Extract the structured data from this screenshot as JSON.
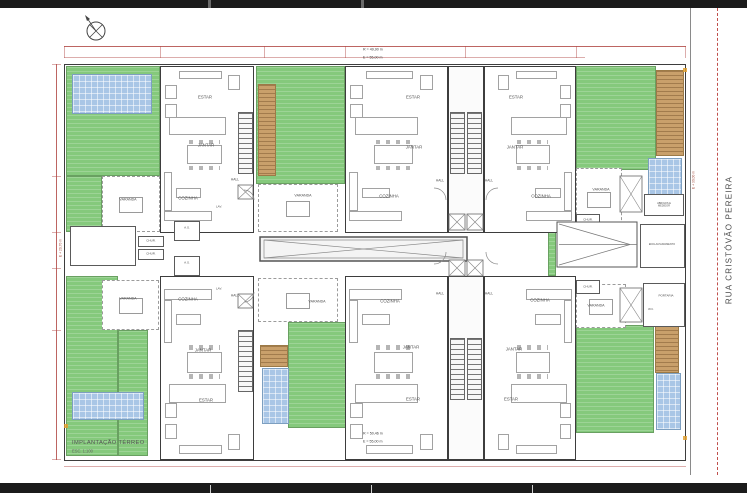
{
  "title_block": {
    "title": "IMPLANTAÇÃO TÉRREO",
    "scale": "ESC. 1:100"
  },
  "annotations": {
    "street": "RUA CRISTÓVÃO PEREIRA",
    "top_levels": [
      "R = 49,90 m",
      "E = 55,00 m"
    ],
    "bottom_levels": [
      "R = 50,46 m",
      "E = 55,00 m"
    ],
    "left_level": "E + 29,70 m",
    "right_level": "E + 30,00 m"
  },
  "colors": {
    "grass": "#85c97c",
    "pool": "#a9c6e6",
    "deck": "#c9a06b",
    "wall": "#3d3d3d",
    "dimension": "#b14a47",
    "furniture": "#a2a2a2"
  },
  "plan": {
    "zones": [
      {
        "kind": "grass",
        "x": 66,
        "y": 66,
        "w": 94,
        "h": 110
      },
      {
        "kind": "grass",
        "x": 66,
        "y": 176,
        "w": 36,
        "h": 56
      },
      {
        "kind": "grass",
        "x": 256,
        "y": 66,
        "w": 89,
        "h": 118
      },
      {
        "kind": "grass",
        "x": 576,
        "y": 66,
        "w": 80,
        "h": 104
      },
      {
        "kind": "grass",
        "x": 66,
        "y": 276,
        "w": 52,
        "h": 180
      },
      {
        "kind": "grass",
        "x": 118,
        "y": 330,
        "w": 30,
        "h": 126
      },
      {
        "kind": "grass",
        "x": 288,
        "y": 322,
        "w": 92,
        "h": 106
      },
      {
        "kind": "grass",
        "x": 576,
        "y": 325,
        "w": 78,
        "h": 108
      },
      {
        "kind": "grass",
        "x": 548,
        "y": 220,
        "w": 8,
        "h": 56
      },
      {
        "kind": "deck",
        "x": 258,
        "y": 84,
        "w": 18,
        "h": 92
      },
      {
        "kind": "deck",
        "x": 656,
        "y": 70,
        "w": 28,
        "h": 86
      },
      {
        "kind": "deck",
        "x": 260,
        "y": 345,
        "w": 28,
        "h": 22
      },
      {
        "kind": "deck",
        "x": 655,
        "y": 325,
        "w": 24,
        "h": 48
      },
      {
        "kind": "pool",
        "x": 72,
        "y": 74,
        "w": 80,
        "h": 40
      },
      {
        "kind": "pool",
        "x": 648,
        "y": 158,
        "w": 34,
        "h": 44
      },
      {
        "kind": "pool",
        "x": 72,
        "y": 392,
        "w": 72,
        "h": 28
      },
      {
        "kind": "pool",
        "x": 262,
        "y": 368,
        "w": 27,
        "h": 56
      },
      {
        "kind": "pool",
        "x": 656,
        "y": 373,
        "w": 25,
        "h": 57
      }
    ],
    "varandas": [
      {
        "x": 102,
        "y": 176,
        "w": 58,
        "h": 56
      },
      {
        "x": 258,
        "y": 184,
        "w": 80,
        "h": 48
      },
      {
        "x": 576,
        "y": 168,
        "w": 46,
        "h": 62
      },
      {
        "x": 102,
        "y": 280,
        "w": 57,
        "h": 50
      },
      {
        "x": 258,
        "y": 278,
        "w": 80,
        "h": 44
      },
      {
        "x": 576,
        "y": 284,
        "w": 50,
        "h": 44
      }
    ],
    "units": [
      {
        "x": 160,
        "y": 66,
        "w": 94,
        "h": 167,
        "flip": false,
        "row": "top"
      },
      {
        "x": 345,
        "y": 66,
        "w": 103,
        "h": 167,
        "flip": false,
        "row": "top"
      },
      {
        "x": 484,
        "y": 66,
        "w": 92,
        "h": 167,
        "flip": true,
        "row": "top"
      },
      {
        "x": 160,
        "y": 276,
        "w": 94,
        "h": 184,
        "flip": false,
        "row": "bottom"
      },
      {
        "x": 345,
        "y": 276,
        "w": 103,
        "h": 184,
        "flip": false,
        "row": "bottom"
      },
      {
        "x": 484,
        "y": 276,
        "w": 92,
        "h": 184,
        "flip": true,
        "row": "bottom"
      }
    ],
    "cores": [
      {
        "x": 448,
        "y": 66,
        "w": 36,
        "h": 167
      },
      {
        "x": 448,
        "y": 276,
        "w": 36,
        "h": 184
      }
    ],
    "stairs": [
      {
        "x": 238,
        "y": 112,
        "w": 15,
        "h": 62,
        "dir": "v"
      },
      {
        "x": 450,
        "y": 112,
        "w": 15,
        "h": 62,
        "dir": "v"
      },
      {
        "x": 467,
        "y": 112,
        "w": 15,
        "h": 62,
        "dir": "v"
      },
      {
        "x": 238,
        "y": 330,
        "w": 15,
        "h": 62,
        "dir": "v"
      },
      {
        "x": 450,
        "y": 338,
        "w": 15,
        "h": 62,
        "dir": "v"
      },
      {
        "x": 467,
        "y": 338,
        "w": 15,
        "h": 62,
        "dir": "v"
      },
      {
        "x": 82,
        "y": 232,
        "w": 42,
        "h": 28,
        "dir": "h"
      }
    ],
    "service_boxes": [
      {
        "x": 70,
        "y": 226,
        "w": 66,
        "h": 40
      },
      {
        "x": 174,
        "y": 221,
        "w": 26,
        "h": 20
      },
      {
        "x": 174,
        "y": 256,
        "w": 26,
        "h": 20
      },
      {
        "x": 138,
        "y": 236,
        "w": 26,
        "h": 11
      },
      {
        "x": 138,
        "y": 249,
        "w": 26,
        "h": 11
      },
      {
        "x": 576,
        "y": 214,
        "w": 24,
        "h": 14
      },
      {
        "x": 576,
        "y": 280,
        "w": 24,
        "h": 14
      },
      {
        "x": 644,
        "y": 194,
        "w": 40,
        "h": 22
      },
      {
        "x": 640,
        "y": 224,
        "w": 45,
        "h": 44
      },
      {
        "x": 643,
        "y": 283,
        "w": 42,
        "h": 44
      }
    ],
    "xboxes": [
      {
        "x": 238,
        "y": 185,
        "w": 15,
        "h": 14
      },
      {
        "x": 238,
        "y": 294,
        "w": 15,
        "h": 14
      },
      {
        "x": 449,
        "y": 214,
        "w": 16,
        "h": 16
      },
      {
        "x": 467,
        "y": 214,
        "w": 16,
        "h": 16
      },
      {
        "x": 449,
        "y": 260,
        "w": 16,
        "h": 16
      },
      {
        "x": 467,
        "y": 260,
        "w": 16,
        "h": 16
      },
      {
        "x": 620,
        "y": 176,
        "w": 22,
        "h": 36
      },
      {
        "x": 620,
        "y": 288,
        "w": 22,
        "h": 34
      }
    ],
    "corridor_box": {
      "x": 260,
      "y": 237,
      "w": 207,
      "h": 24
    },
    "ramp": {
      "x": 557,
      "y": 222,
      "w": 80,
      "h": 45
    },
    "compass": {
      "cx": 96,
      "cy": 31,
      "r": 9
    },
    "rooms": [
      {
        "t": "ESTAR",
        "x": 205,
        "y": 98
      },
      {
        "t": "JANTAR",
        "x": 206,
        "y": 146
      },
      {
        "t": "COZINHA",
        "x": 188,
        "y": 199
      },
      {
        "t": "HALL",
        "x": 235,
        "y": 180,
        "s": 0.55
      },
      {
        "t": "LAV.",
        "x": 219,
        "y": 207,
        "s": 0.5
      },
      {
        "t": "VARANDA",
        "x": 128,
        "y": 200,
        "s": 0.6
      },
      {
        "t": "ESTAR",
        "x": 413,
        "y": 98
      },
      {
        "t": "JANTAR",
        "x": 414,
        "y": 148
      },
      {
        "t": "COZINHA",
        "x": 389,
        "y": 197
      },
      {
        "t": "HALL",
        "x": 440,
        "y": 181,
        "s": 0.55
      },
      {
        "t": "VARANDA",
        "x": 303,
        "y": 196,
        "s": 0.6
      },
      {
        "t": "ESTAR",
        "x": 516,
        "y": 98
      },
      {
        "t": "JANTAR",
        "x": 515,
        "y": 148
      },
      {
        "t": "COZINHA",
        "x": 541,
        "y": 197
      },
      {
        "t": "HALL",
        "x": 489,
        "y": 181,
        "s": 0.55
      },
      {
        "t": "VARANDA",
        "x": 601,
        "y": 190,
        "s": 0.6
      },
      {
        "t": "A.S.",
        "x": 187,
        "y": 228,
        "s": 0.5
      },
      {
        "t": "A.S.",
        "x": 187,
        "y": 263,
        "s": 0.5
      },
      {
        "t": "CHUR.",
        "x": 151,
        "y": 241,
        "s": 0.5
      },
      {
        "t": "CHUR.",
        "x": 151,
        "y": 254,
        "s": 0.5
      },
      {
        "t": "CHUR.",
        "x": 588,
        "y": 220,
        "s": 0.5
      },
      {
        "t": "CHUR.",
        "x": 588,
        "y": 287,
        "s": 0.5
      },
      {
        "t": "ENCLAUSURAMENTO",
        "x": 662,
        "y": 245,
        "s": 0.42
      },
      {
        "t": "ABRIGOS E\nMEDIDOR",
        "x": 664,
        "y": 205,
        "s": 0.42
      },
      {
        "t": "PORTARIA",
        "x": 666,
        "y": 296,
        "s": 0.5
      },
      {
        "t": "W.C.",
        "x": 651,
        "y": 310,
        "s": 0.45
      },
      {
        "t": "VARANDA",
        "x": 128,
        "y": 299,
        "s": 0.6
      },
      {
        "t": "COZINHA",
        "x": 188,
        "y": 300
      },
      {
        "t": "JANTAR",
        "x": 203,
        "y": 351
      },
      {
        "t": "ESTAR",
        "x": 206,
        "y": 401
      },
      {
        "t": "HALL",
        "x": 235,
        "y": 296,
        "s": 0.55
      },
      {
        "t": "LAV.",
        "x": 219,
        "y": 289,
        "s": 0.5
      },
      {
        "t": "VARANDA",
        "x": 317,
        "y": 302,
        "s": 0.6
      },
      {
        "t": "COZINHA",
        "x": 390,
        "y": 302
      },
      {
        "t": "JANTAR",
        "x": 411,
        "y": 348
      },
      {
        "t": "ESTAR",
        "x": 413,
        "y": 400
      },
      {
        "t": "HALL",
        "x": 440,
        "y": 294,
        "s": 0.55
      },
      {
        "t": "COZINHA",
        "x": 540,
        "y": 301
      },
      {
        "t": "JANTAR",
        "x": 514,
        "y": 350
      },
      {
        "t": "ESTAR",
        "x": 511,
        "y": 400
      },
      {
        "t": "HALL",
        "x": 489,
        "y": 294,
        "s": 0.55
      },
      {
        "t": "VARANDA",
        "x": 596,
        "y": 306,
        "s": 0.6
      }
    ]
  }
}
